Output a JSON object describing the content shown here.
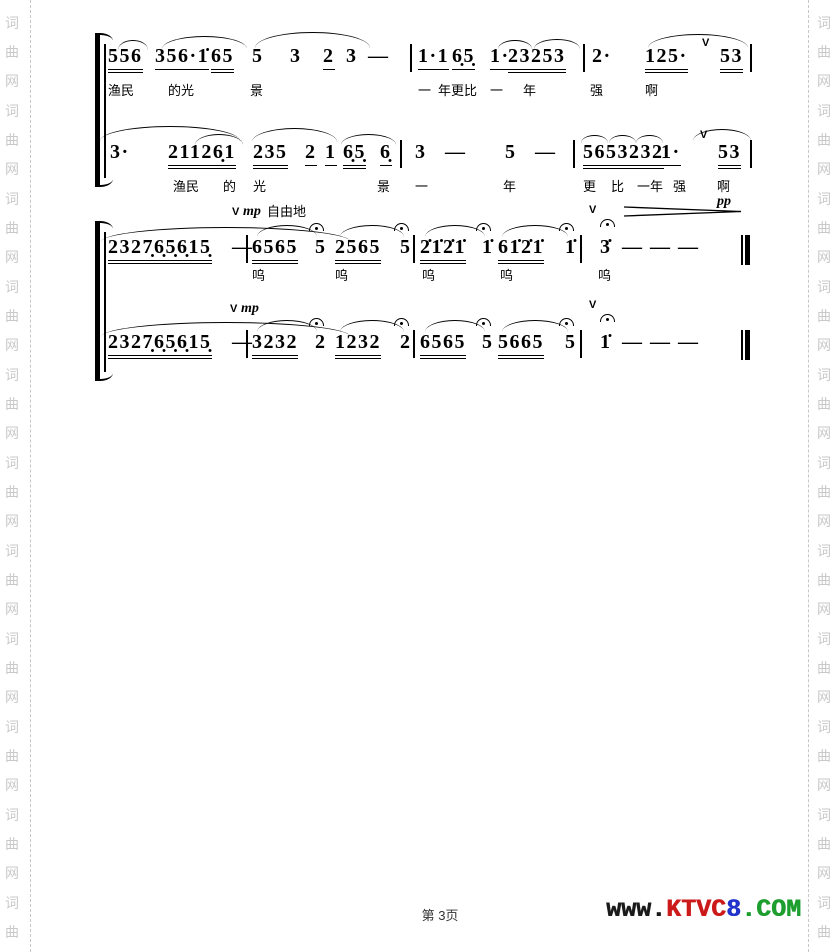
{
  "watermark": {
    "chars": [
      "词",
      "曲",
      "网"
    ],
    "groups": 11
  },
  "score": {
    "dynamics": {
      "mp": "mp",
      "pp": "pp",
      "freely": "自由地",
      "breath": "V"
    },
    "lines": [
      {
        "groups": [
          "556",
          "356·1̇",
          "65",
          "5",
          "3",
          "2",
          "3",
          "—",
          "1·1",
          "6̣5̣",
          "1·",
          "23253",
          "2·",
          "125·",
          "53"
        ],
        "lyrics": [
          "渔民",
          "的光",
          "景",
          "一",
          "年更比",
          "一",
          "年",
          "强",
          "啊"
        ]
      },
      {
        "groups": [
          "3·",
          "21126̣1",
          "235",
          "2",
          "1",
          "6̣5̣",
          "6̣",
          "3",
          "—",
          "5",
          "—",
          "5653232",
          "1·",
          "53"
        ],
        "lyrics": [
          "渔民",
          "的",
          "光",
          "景",
          "一",
          "年",
          "更",
          "比",
          "一年",
          "强",
          "啊"
        ]
      },
      {
        "groups": [
          "2327̣6̣5̣6̣15̣",
          "—",
          "6565",
          "5",
          "2565",
          "5",
          "2̇1̇2̇1̇",
          "1̇",
          "61̇2̇1̇",
          "1̇",
          "3̇",
          "—",
          "—",
          "—"
        ],
        "lyrics": [
          "呜",
          "呜",
          "呜",
          "呜",
          "呜"
        ]
      },
      {
        "groups": [
          "2327̣6̣5̣6̣15̣",
          "—",
          "3232",
          "2",
          "1232",
          "2",
          "6565",
          "5",
          "5665",
          "5",
          "1̇",
          "—",
          "—",
          "—"
        ],
        "lyrics": []
      }
    ]
  },
  "footer": {
    "page_label": "第 3页",
    "logo": {
      "part1": "www.",
      "part2": "KTVC",
      "part3": "8",
      "part4": ".COM"
    },
    "logo_colors": {
      "part1": "#1b1b1b",
      "part2": "#cc1a1a",
      "part3": "#2233cc",
      "part4": "#1d9e2f"
    }
  }
}
